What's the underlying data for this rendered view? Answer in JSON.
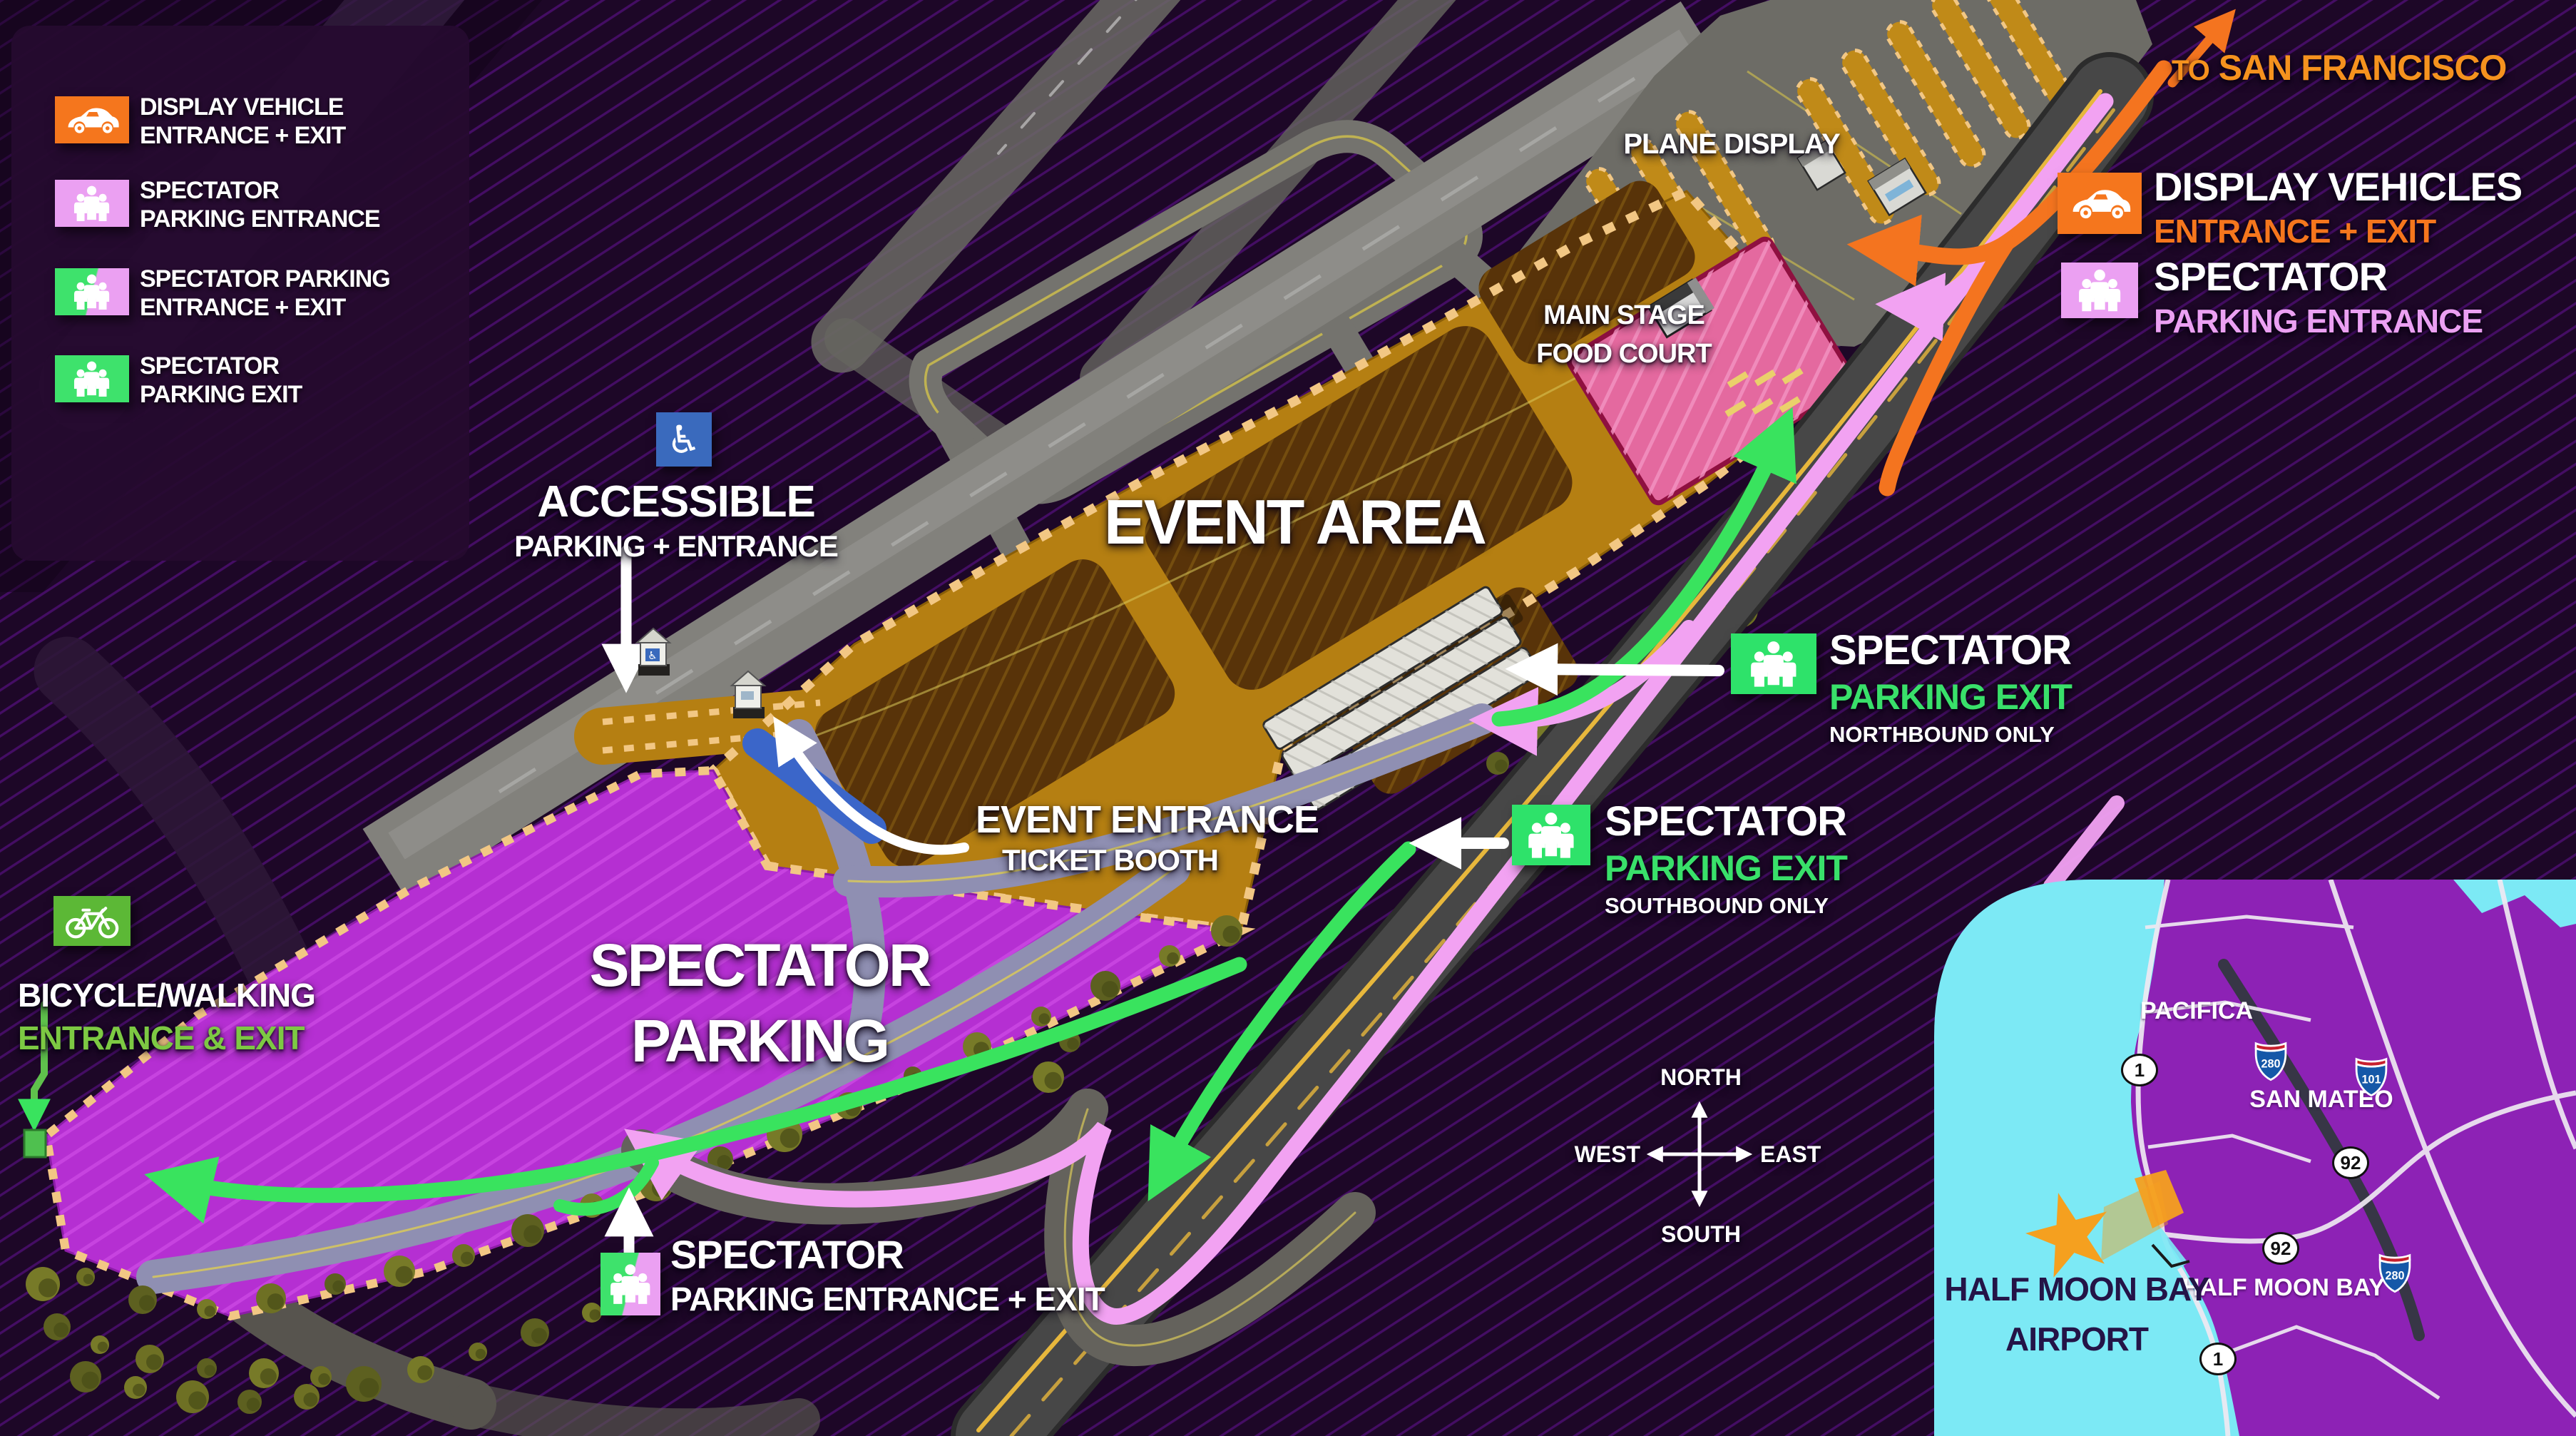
{
  "page": {
    "bg": "#1d0727",
    "stripe": "#6c13a0"
  },
  "legend": {
    "items": [
      {
        "icon": "car",
        "box_left": "#f5761d",
        "box_right": "#f5761d",
        "lines": [
          "DISPLAY VEHICLE",
          "ENTRANCE + EXIT"
        ]
      },
      {
        "icon": "people",
        "box_left": "#eba0f2",
        "box_right": "#eba0f2",
        "lines": [
          "SPECTATOR",
          "PARKING ENTRANCE"
        ]
      },
      {
        "icon": "people",
        "box_left": "#3ee26c",
        "box_right": "#eba0f2",
        "lines": [
          "SPECTATOR PARKING",
          "ENTRANCE + EXIT"
        ]
      },
      {
        "icon": "people",
        "box_left": "#3ee26c",
        "box_right": "#3ee26c",
        "lines": [
          "SPECTATOR",
          "PARKING EXIT"
        ]
      }
    ]
  },
  "map_labels": {
    "event_area": "EVENT AREA",
    "spectator_parking": [
      "SPECTATOR",
      "PARKING"
    ],
    "plane_display": "PLANE DISPLAY",
    "main_stage": [
      "MAIN STAGE",
      "FOOD COURT"
    ]
  },
  "callouts": {
    "to_sf": {
      "prefix": "TO",
      "name": "SAN FRANCISCO",
      "color": "#f5921e"
    },
    "display_vehicles": {
      "line1": "DISPLAY VEHICLES",
      "line2": "ENTRANCE + EXIT",
      "accent": "#f5761d"
    },
    "spectator_entrance": {
      "line1": "SPECTATOR",
      "line2": "PARKING ENTRANCE",
      "accent": "#eba0f2"
    },
    "exit_north": {
      "line1": "SPECTATOR",
      "line2": "PARKING EXIT",
      "line3": "NORTHBOUND ONLY",
      "accent": "#39e06a"
    },
    "exit_south": {
      "line1": "SPECTATOR",
      "line2": "PARKING EXIT",
      "line3": "SOUTHBOUND ONLY",
      "accent": "#39e06a"
    },
    "accessible": {
      "line1": "ACCESSIBLE",
      "line2": "PARKING + ENTRANCE"
    },
    "event_entrance": {
      "line1": "EVENT ENTRANCE",
      "line2": "TICKET BOOTH"
    },
    "bicycle": {
      "line1": "BICYCLE/WALKING",
      "line2": "ENTRANCE & EXIT",
      "accent": "#7dc943"
    },
    "spectator_bottom": {
      "line1": "SPECTATOR",
      "line2": "PARKING ENTRANCE + EXIT"
    }
  },
  "compass": {
    "north": "NORTH",
    "south": "SOUTH",
    "east": "EAST",
    "west": "WEST"
  },
  "inset": {
    "cities": [
      "PACIFICA",
      "SAN MATEO",
      "HALF MOON BAY"
    ],
    "airport_label": [
      "HALF MOON BAY",
      "AIRPORT"
    ],
    "shields": [
      {
        "type": "interstate",
        "num": "280"
      },
      {
        "type": "interstate",
        "num": "101"
      },
      {
        "type": "interstate",
        "num": "280"
      },
      {
        "type": "oval",
        "num": "1"
      },
      {
        "type": "oval",
        "num": "92"
      },
      {
        "type": "oval",
        "num": "92"
      },
      {
        "type": "oval",
        "num": "1"
      }
    ],
    "water": "#7ce9f5",
    "land": "#8d22b5"
  }
}
